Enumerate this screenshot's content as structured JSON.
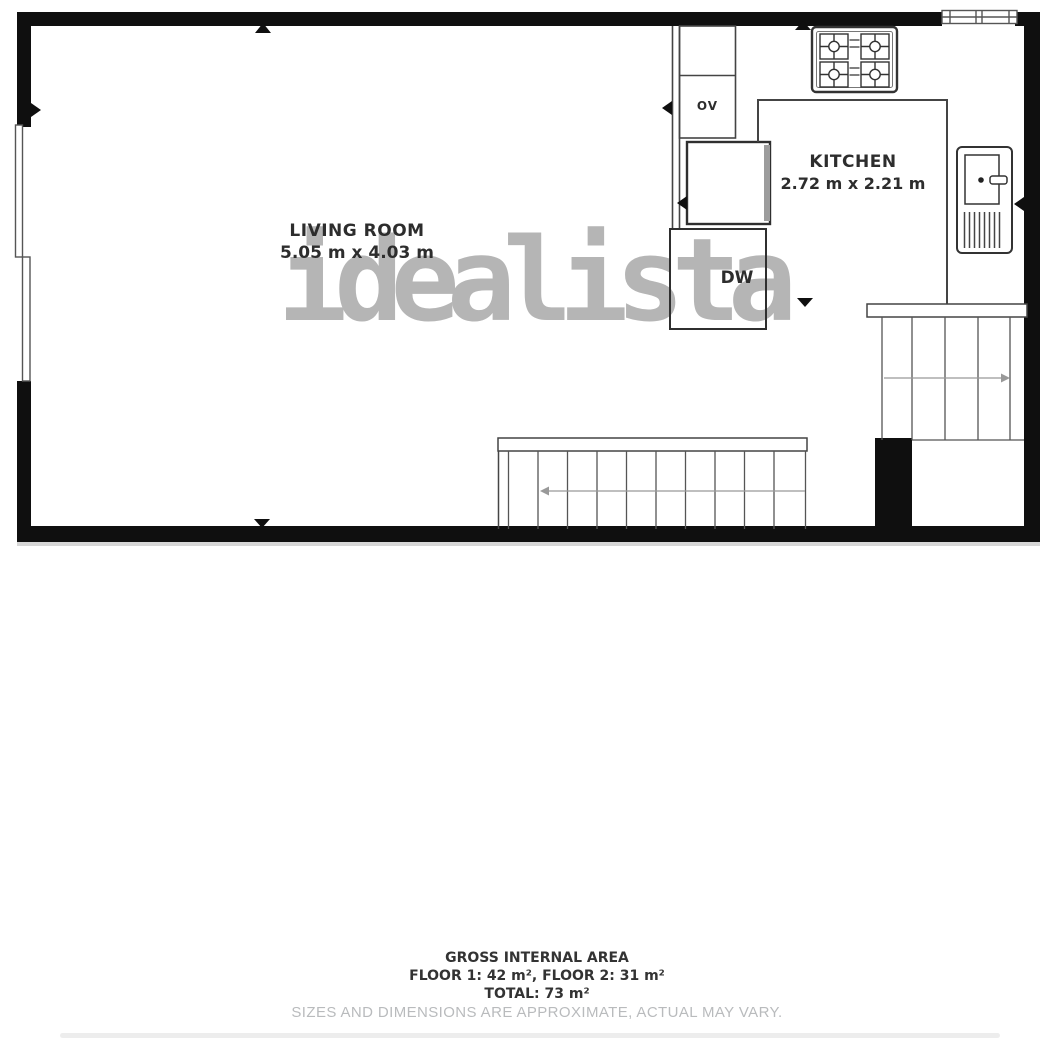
{
  "watermark": {
    "text": "idealista",
    "color": "#b5b5b5"
  },
  "rooms": {
    "living_room": {
      "name": "LIVING ROOM",
      "dimensions": "5.05 m x 4.03 m"
    },
    "kitchen": {
      "name": "KITCHEN",
      "dimensions": "2.72 m x 2.21 m"
    }
  },
  "appliances": {
    "oven_label": "OV",
    "dishwasher_label": "DW"
  },
  "footer": {
    "title": "GROSS INTERNAL AREA",
    "floor_breakdown": "FLOOR 1: 42 m², FLOOR 2: 31 m²",
    "total": "TOTAL: 73 m²",
    "disclaimer": "SIZES AND DIMENSIONS ARE APPROXIMATE, ACTUAL MAY VARY."
  },
  "colors": {
    "walls": "#0f0f0f",
    "thin_lines": "#444444",
    "label_text": "#2d2d2d",
    "watermark_gray": "#b5b5b5",
    "disclaimer_gray": "#b9bbbd",
    "stair_arrow_gray": "#999999"
  }
}
